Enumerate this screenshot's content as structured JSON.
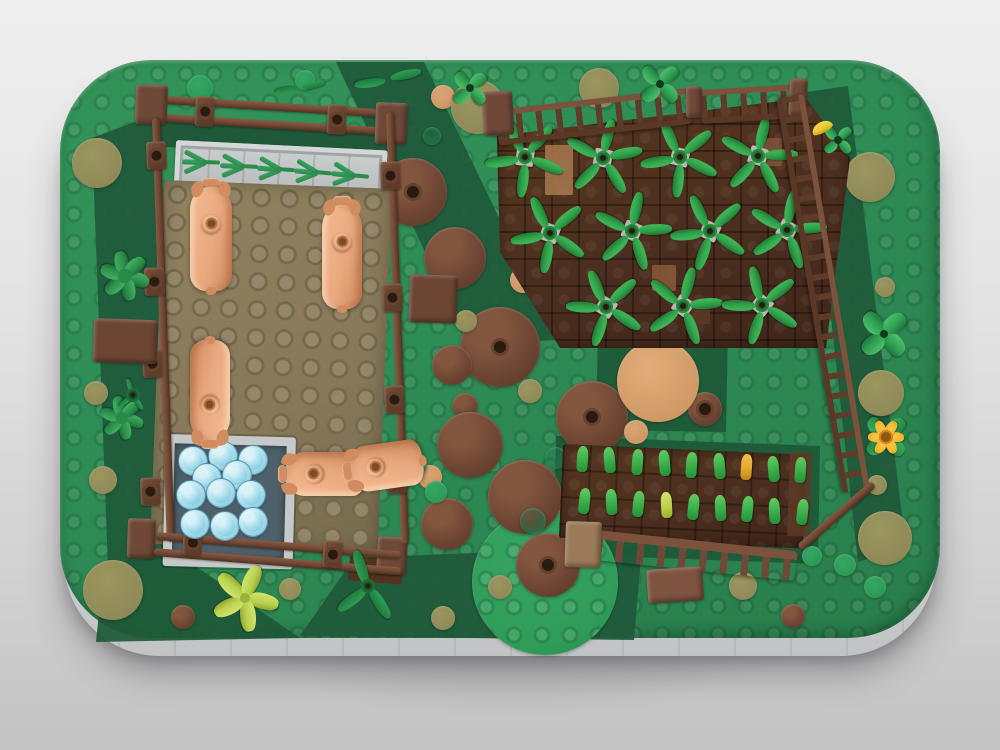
{
  "image_kind": "lego-3d-render-top-view-farm",
  "colors": {
    "fence": "#6f4837",
    "fence_dark": "#53331f",
    "wedge": "#1f5939",
    "wedge2": "#1d5837",
    "pig": "#e9a87e",
    "pig_dark": "#d18c60",
    "pig_hi": "#f2b78d",
    "plant": "#2f9e48",
    "plant_dark": "#1f7a33",
    "plant_base": "#b9b8b4",
    "sprout": "#3cb24c",
    "gold": "#e3a92f",
    "lime": "#bcd24a",
    "br": "#6d4533",
    "tan": "#cf9766",
    "mh": "#d8a06b",
    "ol": "#8f8a58",
    "gr": "#2c9a57",
    "dg": "#20744a",
    "gp": "#2f9b58",
    "bush": "#2f9e52",
    "bush_dark": "#278a47",
    "lime_bush": "#b9d14c",
    "fern": "#2d8a4e",
    "flower_y": "#f0b429",
    "flower_c": "#8a5a14",
    "banana": "#e8c832",
    "tanbrick": "#9b7a58",
    "brown_hi": "#7d5440"
  },
  "scene": {
    "shadow": {
      "x": 55,
      "y": 120,
      "w": 910,
      "h": 600
    },
    "skirt": {
      "x": 64,
      "y": 80,
      "w": 872,
      "h": 576
    },
    "base": {
      "x": 60,
      "y": 60,
      "w": 880,
      "h": 578
    },
    "wedges": [
      {
        "pts": "336,62 424,62 558,340 468,344",
        "c": "wedge"
      },
      {
        "pts": "92,138 150,116 180,556 108,568",
        "c": "wedge"
      },
      {
        "pts": "300,636 354,558 642,546 634,640",
        "c": "wedge"
      },
      {
        "pts": "806,92 848,86 906,546 858,562",
        "c": "wedge"
      },
      {
        "pts": "104,564 178,554 300,638 96,642",
        "c": "wedge2"
      },
      {
        "pts": "598,328 728,330 726,432 596,430",
        "c": "wedge2"
      },
      {
        "pts": "556,436 820,446 818,564 554,554",
        "c": "wedge2"
      }
    ],
    "circles": [
      [
        545,
        582,
        73,
        "gp",
        0
      ],
      [
        413,
        192,
        34,
        "br",
        1
      ],
      [
        455,
        258,
        31,
        "br",
        0
      ],
      [
        500,
        347,
        40,
        "br",
        1
      ],
      [
        452,
        365,
        20,
        "br",
        0
      ],
      [
        465,
        406,
        13,
        "br",
        0
      ],
      [
        470,
        445,
        33,
        "br",
        0
      ],
      [
        525,
        497,
        37,
        "br",
        0
      ],
      [
        447,
        524,
        26,
        "br",
        0
      ],
      [
        548,
        565,
        32,
        "br",
        1
      ],
      [
        592,
        417,
        36,
        "br",
        1
      ],
      [
        705,
        409,
        17,
        "br",
        1
      ],
      [
        793,
        616,
        12,
        "br",
        0
      ],
      [
        183,
        617,
        12,
        "br",
        0
      ],
      [
        658,
        381,
        41,
        "mh",
        0
      ],
      [
        636,
        432,
        12,
        "tan",
        0
      ],
      [
        523,
        280,
        13,
        "tan",
        0
      ],
      [
        430,
        477,
        12,
        "tan",
        0
      ],
      [
        443,
        97,
        12,
        "tan",
        0
      ],
      [
        478,
        107,
        27,
        "ol",
        0
      ],
      [
        599,
        88,
        20,
        "ol",
        0
      ],
      [
        513,
        196,
        12,
        "ol",
        0
      ],
      [
        466,
        321,
        11,
        "ol",
        0
      ],
      [
        530,
        391,
        12,
        "ol",
        0
      ],
      [
        97,
        163,
        25,
        "ol",
        0
      ],
      [
        178,
        317,
        14,
        "ol",
        0
      ],
      [
        96,
        393,
        12,
        "ol",
        0
      ],
      [
        103,
        480,
        14,
        "ol",
        0
      ],
      [
        113,
        590,
        30,
        "ol",
        0
      ],
      [
        870,
        177,
        25,
        "ol",
        0
      ],
      [
        885,
        287,
        10,
        "ol",
        0
      ],
      [
        881,
        393,
        23,
        "ol",
        0
      ],
      [
        877,
        485,
        10,
        "ol",
        0
      ],
      [
        885,
        538,
        27,
        "ol",
        0
      ],
      [
        743,
        586,
        14,
        "ol",
        0
      ],
      [
        500,
        587,
        12,
        "ol",
        0
      ],
      [
        443,
        618,
        12,
        "ol",
        0
      ],
      [
        290,
        589,
        11,
        "ol",
        0
      ],
      [
        200,
        88,
        13,
        "gr",
        0
      ],
      [
        305,
        80,
        10,
        "gr",
        0
      ],
      [
        414,
        464,
        13,
        "gr",
        0
      ],
      [
        436,
        492,
        11,
        "gr",
        0
      ],
      [
        845,
        565,
        11,
        "gr",
        0
      ],
      [
        875,
        587,
        11,
        "gr",
        0
      ],
      [
        812,
        556,
        10,
        "gr",
        0
      ],
      [
        432,
        136,
        9,
        "dg",
        0
      ],
      [
        556,
        458,
        11,
        "dg",
        0
      ],
      [
        533,
        521,
        13,
        "dg",
        0
      ],
      [
        617,
        524,
        11,
        "dg",
        0
      ]
    ],
    "soil_top": {
      "pts": "497,136 806,98 850,158 826,348 560,348 500,252"
    },
    "soil_bottom": {
      "x": 563,
      "y": 444,
      "w": 244,
      "h": 94,
      "rot": 2.5
    },
    "soil_patches": [
      [
        545,
        145,
        28,
        50,
        0,
        "#a8794f"
      ],
      [
        652,
        265,
        24,
        26,
        0,
        "#8a5a3a"
      ],
      [
        758,
        138,
        24,
        28,
        0,
        "#83543a"
      ],
      [
        688,
        300,
        22,
        24,
        0,
        "#5d3925"
      ],
      [
        790,
        452,
        22,
        84,
        2,
        "#5d3a26"
      ]
    ],
    "boxes": [
      [
        150,
        120,
        240,
        26,
        3,
        "wedge",
        "flat"
      ],
      [
        176,
        140,
        212,
        50,
        2.8,
        "",
        "feeder"
      ],
      [
        164,
        180,
        228,
        364,
        2.2,
        "",
        "floor"
      ],
      [
        148,
        95,
        246,
        8,
        3.5,
        "",
        "bar"
      ],
      [
        147,
        113,
        248,
        8,
        3.5,
        "",
        "bar"
      ],
      [
        136,
        84,
        32,
        40,
        2,
        "fence",
        "brick"
      ],
      [
        376,
        102,
        32,
        42,
        2,
        "fence",
        "brick"
      ],
      [
        128,
        518,
        28,
        40,
        2,
        "fence",
        "brick"
      ],
      [
        378,
        536,
        30,
        38,
        3,
        "fence",
        "brick"
      ],
      [
        196,
        96,
        19,
        30,
        3,
        "",
        "post",
        1
      ],
      [
        328,
        104,
        19,
        30,
        3,
        "",
        "post",
        1
      ],
      [
        152,
        118,
        8,
        424,
        -2,
        "",
        "barv"
      ],
      [
        146,
        142,
        20,
        28,
        -2,
        "",
        "post",
        1
      ],
      [
        144,
        268,
        20,
        28,
        -2,
        "",
        "post",
        1
      ],
      [
        142,
        350,
        20,
        28,
        -2,
        "",
        "post",
        1
      ],
      [
        140,
        478,
        20,
        28,
        -2,
        "",
        "post",
        1
      ],
      [
        386,
        112,
        8,
        432,
        -2,
        "",
        "barv"
      ],
      [
        380,
        162,
        20,
        28,
        -2,
        "",
        "post",
        1
      ],
      [
        382,
        284,
        20,
        28,
        -2,
        "",
        "post",
        1
      ],
      [
        384,
        386,
        20,
        28,
        -2,
        "",
        "post",
        1
      ],
      [
        386,
        466,
        20,
        28,
        -2,
        "",
        "post",
        1
      ],
      [
        156,
        532,
        246,
        8,
        4.5,
        "",
        "bar"
      ],
      [
        154,
        548,
        248,
        8,
        4.5,
        "",
        "bar"
      ],
      [
        184,
        528,
        19,
        27,
        4,
        "",
        "post",
        1
      ],
      [
        324,
        540,
        19,
        27,
        4,
        "",
        "post",
        1
      ],
      [
        350,
        556,
        54,
        24,
        5,
        "fence_dark",
        "flat"
      ],
      [
        166,
        434,
        112,
        114,
        1.5,
        "",
        "trough"
      ],
      [
        495,
        110,
        194,
        24,
        -6.5,
        "",
        "ladder"
      ],
      [
        700,
        90,
        102,
        22,
        -3.5,
        "",
        "ladder"
      ],
      [
        686,
        86,
        16,
        32,
        0,
        "fence",
        "brick"
      ],
      [
        790,
        78,
        18,
        38,
        3,
        "fence",
        "brick"
      ],
      [
        804,
        94,
        400,
        16,
        80.5,
        "",
        "ladder"
      ],
      [
        797,
        545,
        98,
        8,
        -41,
        "",
        "bar"
      ],
      [
        597,
        530,
        202,
        30,
        6,
        "",
        "picket"
      ],
      [
        566,
        521,
        36,
        46,
        2,
        "tanbrick",
        "brick"
      ],
      [
        646,
        570,
        56,
        34,
        -4,
        "brown_hi",
        "brick"
      ],
      [
        410,
        274,
        48,
        48,
        2,
        "br",
        "brick"
      ],
      [
        94,
        318,
        64,
        44,
        2,
        "br",
        "brick"
      ],
      [
        482,
        92,
        30,
        44,
        -3,
        "fence",
        "brick"
      ]
    ],
    "water_studs": [
      [
        192,
        460
      ],
      [
        222,
        455
      ],
      [
        252,
        459
      ],
      [
        206,
        477
      ],
      [
        236,
        474
      ],
      [
        190,
        494
      ],
      [
        220,
        492
      ],
      [
        250,
        494
      ],
      [
        194,
        523
      ],
      [
        224,
        525
      ],
      [
        252,
        521
      ]
    ],
    "water_stud_r": 14,
    "ferns": [
      [
        202,
        162
      ],
      [
        240,
        166
      ],
      [
        277,
        169
      ],
      [
        314,
        172
      ],
      [
        351,
        175
      ]
    ],
    "plants": [
      [
        525,
        157
      ],
      [
        603,
        158
      ],
      [
        680,
        157
      ],
      [
        758,
        156
      ],
      [
        550,
        233
      ],
      [
        632,
        231
      ],
      [
        710,
        231
      ],
      [
        787,
        230
      ],
      [
        606,
        307
      ],
      [
        683,
        306
      ],
      [
        762,
        305
      ]
    ],
    "sprout_rows": [
      {
        "y": 446,
        "x0": 577,
        "dx": 27.3,
        "slope": 1.4,
        "colors": [
          "sprout",
          "sprout",
          "sprout",
          "sprout",
          "sprout",
          "sprout",
          "gold",
          "sprout",
          "sprout"
        ]
      },
      {
        "y": 488,
        "x0": 579,
        "dx": 27.2,
        "slope": 1.4,
        "colors": [
          "sprout",
          "sprout",
          "sprout",
          "lime",
          "sprout",
          "sprout",
          "sprout",
          "sprout",
          "sprout"
        ]
      }
    ],
    "pigs": [
      {
        "cx": 211,
        "cy": 237,
        "w": 42,
        "len": 112,
        "dir": "up"
      },
      {
        "cx": 342,
        "cy": 255,
        "w": 40,
        "len": 112,
        "dir": "up"
      },
      {
        "cx": 210,
        "cy": 392,
        "w": 40,
        "len": 108,
        "dir": "down"
      },
      {
        "cx": 324,
        "cy": 474,
        "w": 44,
        "len": 86,
        "dir": "left"
      },
      {
        "cx": 385,
        "cy": 466,
        "w": 46,
        "len": 80,
        "dir": "left",
        "rot": -8
      }
    ],
    "bushes": [
      {
        "x": 125,
        "y": 276,
        "r": 22,
        "t": "bush"
      },
      {
        "x": 122,
        "y": 418,
        "r": 19,
        "t": "bush"
      },
      {
        "x": 245,
        "y": 598,
        "r": 26,
        "t": "lime"
      },
      {
        "x": 368,
        "y": 586,
        "r": 22,
        "t": "leaf3"
      },
      {
        "x": 133,
        "y": 395,
        "r": 9,
        "t": "leaf3"
      },
      {
        "x": 388,
        "y": 80,
        "r": 17,
        "t": "leaf2"
      },
      {
        "x": 300,
        "y": 88,
        "r": 12,
        "t": "leaf2"
      },
      {
        "x": 470,
        "y": 88,
        "r": 15,
        "t": "clover"
      },
      {
        "x": 660,
        "y": 84,
        "r": 17,
        "t": "clover"
      },
      {
        "x": 884,
        "y": 334,
        "r": 21,
        "t": "clover"
      },
      {
        "x": 838,
        "y": 140,
        "r": 12,
        "t": "clover"
      },
      {
        "x": 822,
        "y": 127,
        "r": 11,
        "t": "banana"
      },
      {
        "x": 886,
        "y": 437,
        "r": 19,
        "t": "flower"
      }
    ]
  }
}
